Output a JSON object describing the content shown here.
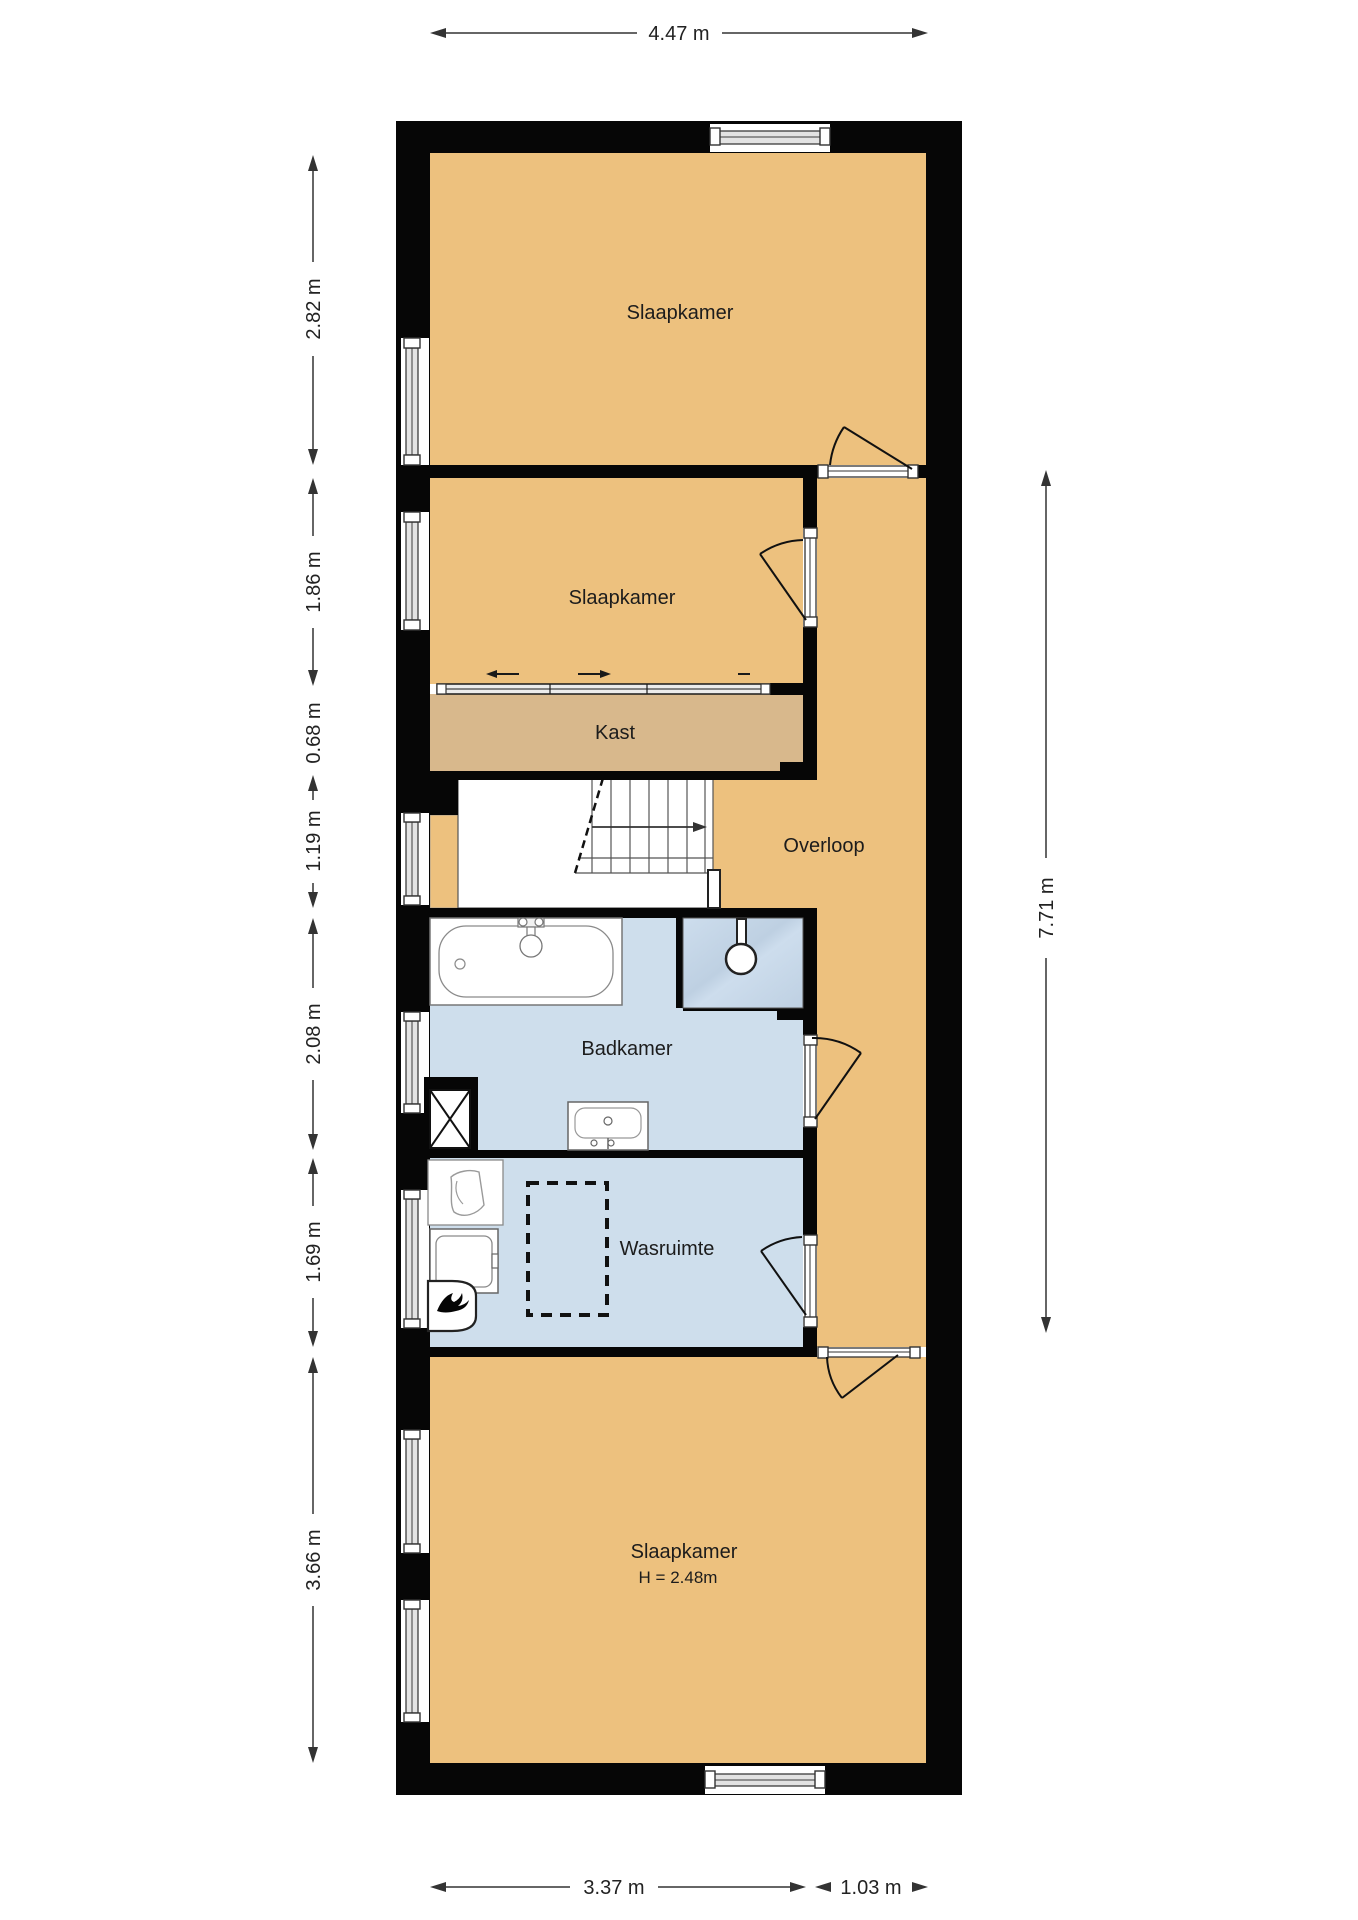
{
  "rooms": {
    "slaapkamer_top": {
      "label": "Slaapkamer"
    },
    "slaapkamer_middle": {
      "label": "Slaapkamer"
    },
    "kast": {
      "label": "Kast"
    },
    "overloop": {
      "label": "Overloop"
    },
    "badkamer": {
      "label": "Badkamer"
    },
    "wasruimte": {
      "label": "Wasruimte"
    },
    "slaapkamer_bottom": {
      "label": "Slaapkamer",
      "ceiling_height": "H = 2.48m"
    }
  },
  "dimensions": {
    "top_width": "4.47 m",
    "left": [
      "2.82 m",
      "1.86 m",
      "0.68 m",
      "1.19 m",
      "2.08 m",
      "1.69 m",
      "3.66 m"
    ],
    "right_height": "7.71 m",
    "bottom": [
      "3.37 m",
      "1.03 m"
    ]
  },
  "colors": {
    "wall": "#060606",
    "floor_orange": "#EDC17E",
    "floor_tan": "#D8B88C",
    "floor_blue": "#CEDEEC",
    "shower_blue": "#C3D5E5"
  }
}
